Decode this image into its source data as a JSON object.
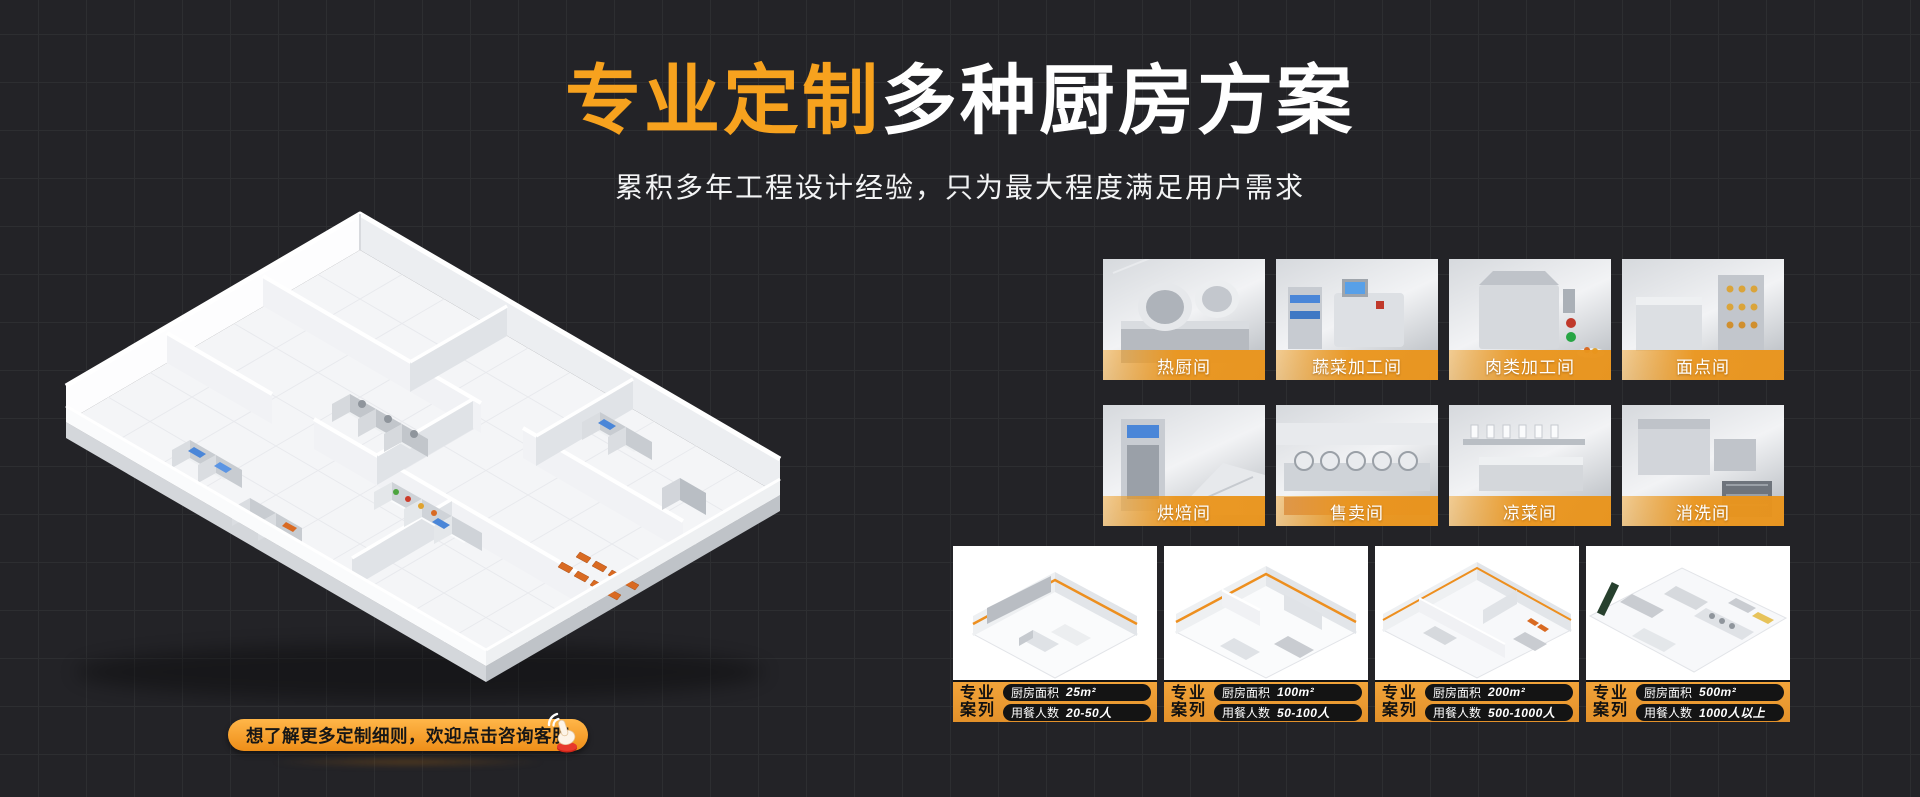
{
  "theme": {
    "background": "#232327",
    "grid_line": "#2d2e31",
    "accent": "#F7A21E",
    "tile_label_bg": "#E9942C",
    "card_footer_bg": "#E9992F",
    "pill_bg": "#141414",
    "cta_gradient_top": "#FFB649",
    "cta_gradient_bottom": "#EE8E18"
  },
  "header": {
    "title_accent": "专业定制",
    "title_main": "多种厨房方案",
    "subtitle": "累积多年工程设计经验，只为最大程度满足用户需求"
  },
  "floorplan": {
    "description": "isometric-3d-kitchen-floorplan-render"
  },
  "rooms": {
    "items": [
      "热厨间",
      "蔬菜加工间",
      "肉类加工间",
      "面点间",
      "烘焙间",
      "售卖间",
      "凉菜间",
      "消洗间"
    ]
  },
  "cases": {
    "badge_line1": "专业",
    "badge_line2": "案列",
    "area_label": "厨房面积",
    "diners_label": "用餐人数",
    "items": [
      {
        "area_value": "25m²",
        "diners_value": "20-50人"
      },
      {
        "area_value": "100m²",
        "diners_value": "50-100人"
      },
      {
        "area_value": "200m²",
        "diners_value": "500-1000人"
      },
      {
        "area_value": "500m²",
        "diners_value": "1000人以上"
      }
    ]
  },
  "cta": {
    "label": "想了解更多定制细则，欢迎点击咨询客服",
    "icon": "hand-click-icon"
  }
}
